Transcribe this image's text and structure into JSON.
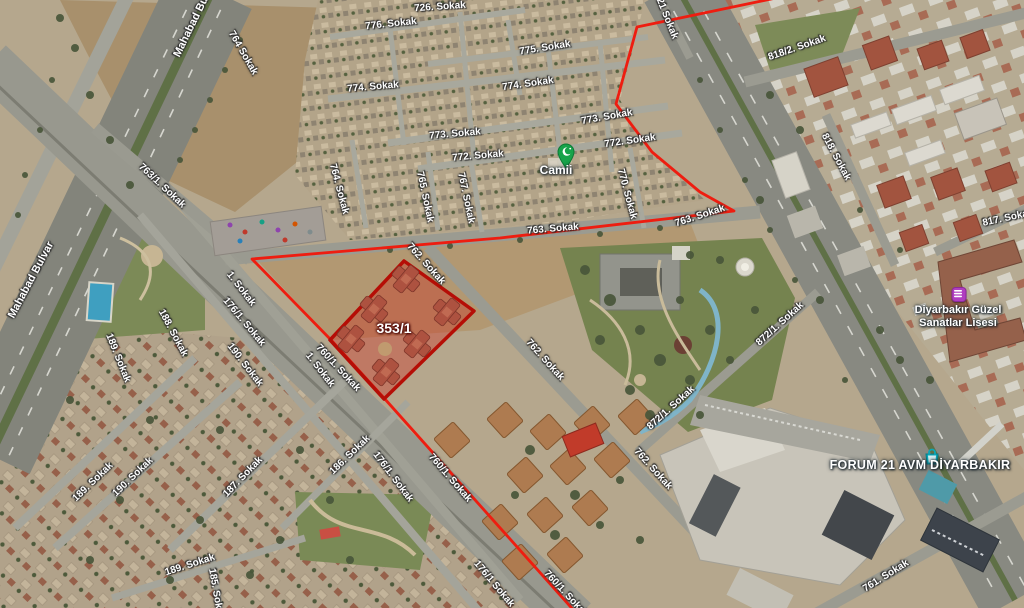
{
  "map": {
    "type": "satellite",
    "parcel": {
      "label": "353/1"
    },
    "poi": {
      "mosque": {
        "label": "Camii"
      },
      "school": {
        "label_line1": "Diyarbakır Güzel",
        "label_line2": "Sanatlar Lisesi"
      },
      "mall": {
        "label": "FORUM 21 AVM DİYARBAKIR"
      }
    },
    "street_labels": [
      {
        "t": "Mahabad Bu",
        "x": 191,
        "y": 27,
        "r": -64,
        "s": 11
      },
      {
        "t": "Mahabad Bulvar",
        "x": 31,
        "y": 280,
        "r": -62,
        "s": 11
      },
      {
        "t": "764 Sokak",
        "x": 243,
        "y": 53,
        "r": 60
      },
      {
        "t": "763/1. Sokak",
        "x": 162,
        "y": 186,
        "r": 43
      },
      {
        "t": "726. Sokak",
        "x": 440,
        "y": 7,
        "r": -4
      },
      {
        "t": "776. Sokak",
        "x": 391,
        "y": 24,
        "r": -6
      },
      {
        "t": "775. Sokak",
        "x": 545,
        "y": 48,
        "r": -9
      },
      {
        "t": "774. Sokak",
        "x": 373,
        "y": 87,
        "r": -5
      },
      {
        "t": "774. Sokak",
        "x": 528,
        "y": 84,
        "r": -8
      },
      {
        "t": "773. Sokak",
        "x": 607,
        "y": 117,
        "r": -10
      },
      {
        "t": "773. Sokak",
        "x": 455,
        "y": 134,
        "r": -5
      },
      {
        "t": "772. Sokak",
        "x": 478,
        "y": 156,
        "r": -5
      },
      {
        "t": "772. Sokak",
        "x": 630,
        "y": 141,
        "r": -8
      },
      {
        "t": "764. Sokak",
        "x": 339,
        "y": 189,
        "r": 75
      },
      {
        "t": "765. Sokak",
        "x": 425,
        "y": 197,
        "r": 78
      },
      {
        "t": "767. Sokak",
        "x": 466,
        "y": 198,
        "r": 78
      },
      {
        "t": "770. Sokak",
        "x": 627,
        "y": 194,
        "r": 75
      },
      {
        "t": "763. Sokak",
        "x": 553,
        "y": 229,
        "r": -5
      },
      {
        "t": "763. Sokak",
        "x": 700,
        "y": 216,
        "r": -18
      },
      {
        "t": "762. Sokak",
        "x": 426,
        "y": 264,
        "r": 48
      },
      {
        "t": "762. Sokak",
        "x": 545,
        "y": 360,
        "r": 48
      },
      {
        "t": "762. Sokak",
        "x": 653,
        "y": 469,
        "r": 48
      },
      {
        "t": "1. Sokak",
        "x": 241,
        "y": 289,
        "r": 52
      },
      {
        "t": "176/1. Sokak",
        "x": 244,
        "y": 322,
        "r": 50
      },
      {
        "t": "188. Sokak",
        "x": 173,
        "y": 333,
        "r": 62
      },
      {
        "t": "189. Sokak",
        "x": 118,
        "y": 358,
        "r": 68
      },
      {
        "t": "190. Sokak",
        "x": 245,
        "y": 365,
        "r": 52
      },
      {
        "t": "1. Sokak",
        "x": 320,
        "y": 370,
        "r": 52
      },
      {
        "t": "760/1. Sokak",
        "x": 338,
        "y": 368,
        "r": 47
      },
      {
        "t": "760/1. Sokak",
        "x": 450,
        "y": 478,
        "r": 49
      },
      {
        "t": "760/1. Sokak",
        "x": 566,
        "y": 594,
        "r": 47
      },
      {
        "t": "176/1. Sokak",
        "x": 393,
        "y": 477,
        "r": 53
      },
      {
        "t": "176/1 Sokak",
        "x": 494,
        "y": 584,
        "r": 50
      },
      {
        "t": "190. Sokak",
        "x": 133,
        "y": 477,
        "r": -44
      },
      {
        "t": "189. Sokak",
        "x": 93,
        "y": 482,
        "r": -44
      },
      {
        "t": "187. Sokak",
        "x": 243,
        "y": 477,
        "r": -46
      },
      {
        "t": "189. Sokak",
        "x": 190,
        "y": 565,
        "r": -18
      },
      {
        "t": "186. Sokak",
        "x": 350,
        "y": 455,
        "r": -44
      },
      {
        "t": "185. Sokak",
        "x": 216,
        "y": 594,
        "r": 80
      },
      {
        "t": "818/2. Sokak",
        "x": 797,
        "y": 48,
        "r": -19
      },
      {
        "t": "818. Sokak",
        "x": 836,
        "y": 157,
        "r": 62
      },
      {
        "t": "821 Sokak",
        "x": 666,
        "y": 16,
        "r": 68
      },
      {
        "t": "817. Sokak",
        "x": 1008,
        "y": 218,
        "r": -12
      },
      {
        "t": "872/1. Sokak",
        "x": 780,
        "y": 324,
        "r": -42
      },
      {
        "t": "872/1. Sokak",
        "x": 671,
        "y": 408,
        "r": -42
      },
      {
        "t": "761. Sokak",
        "x": 886,
        "y": 576,
        "r": -32
      }
    ],
    "colors": {
      "boundary_red": "#ee1d10",
      "parcel_border": "#b50e06",
      "parcel_fill": "rgba(210,25,15,0.32)",
      "mosque_green": "#17a34a",
      "school_purple": "#b03ec0",
      "mall_teal": "#0ba6b6",
      "label_white": "#ffffff"
    }
  }
}
